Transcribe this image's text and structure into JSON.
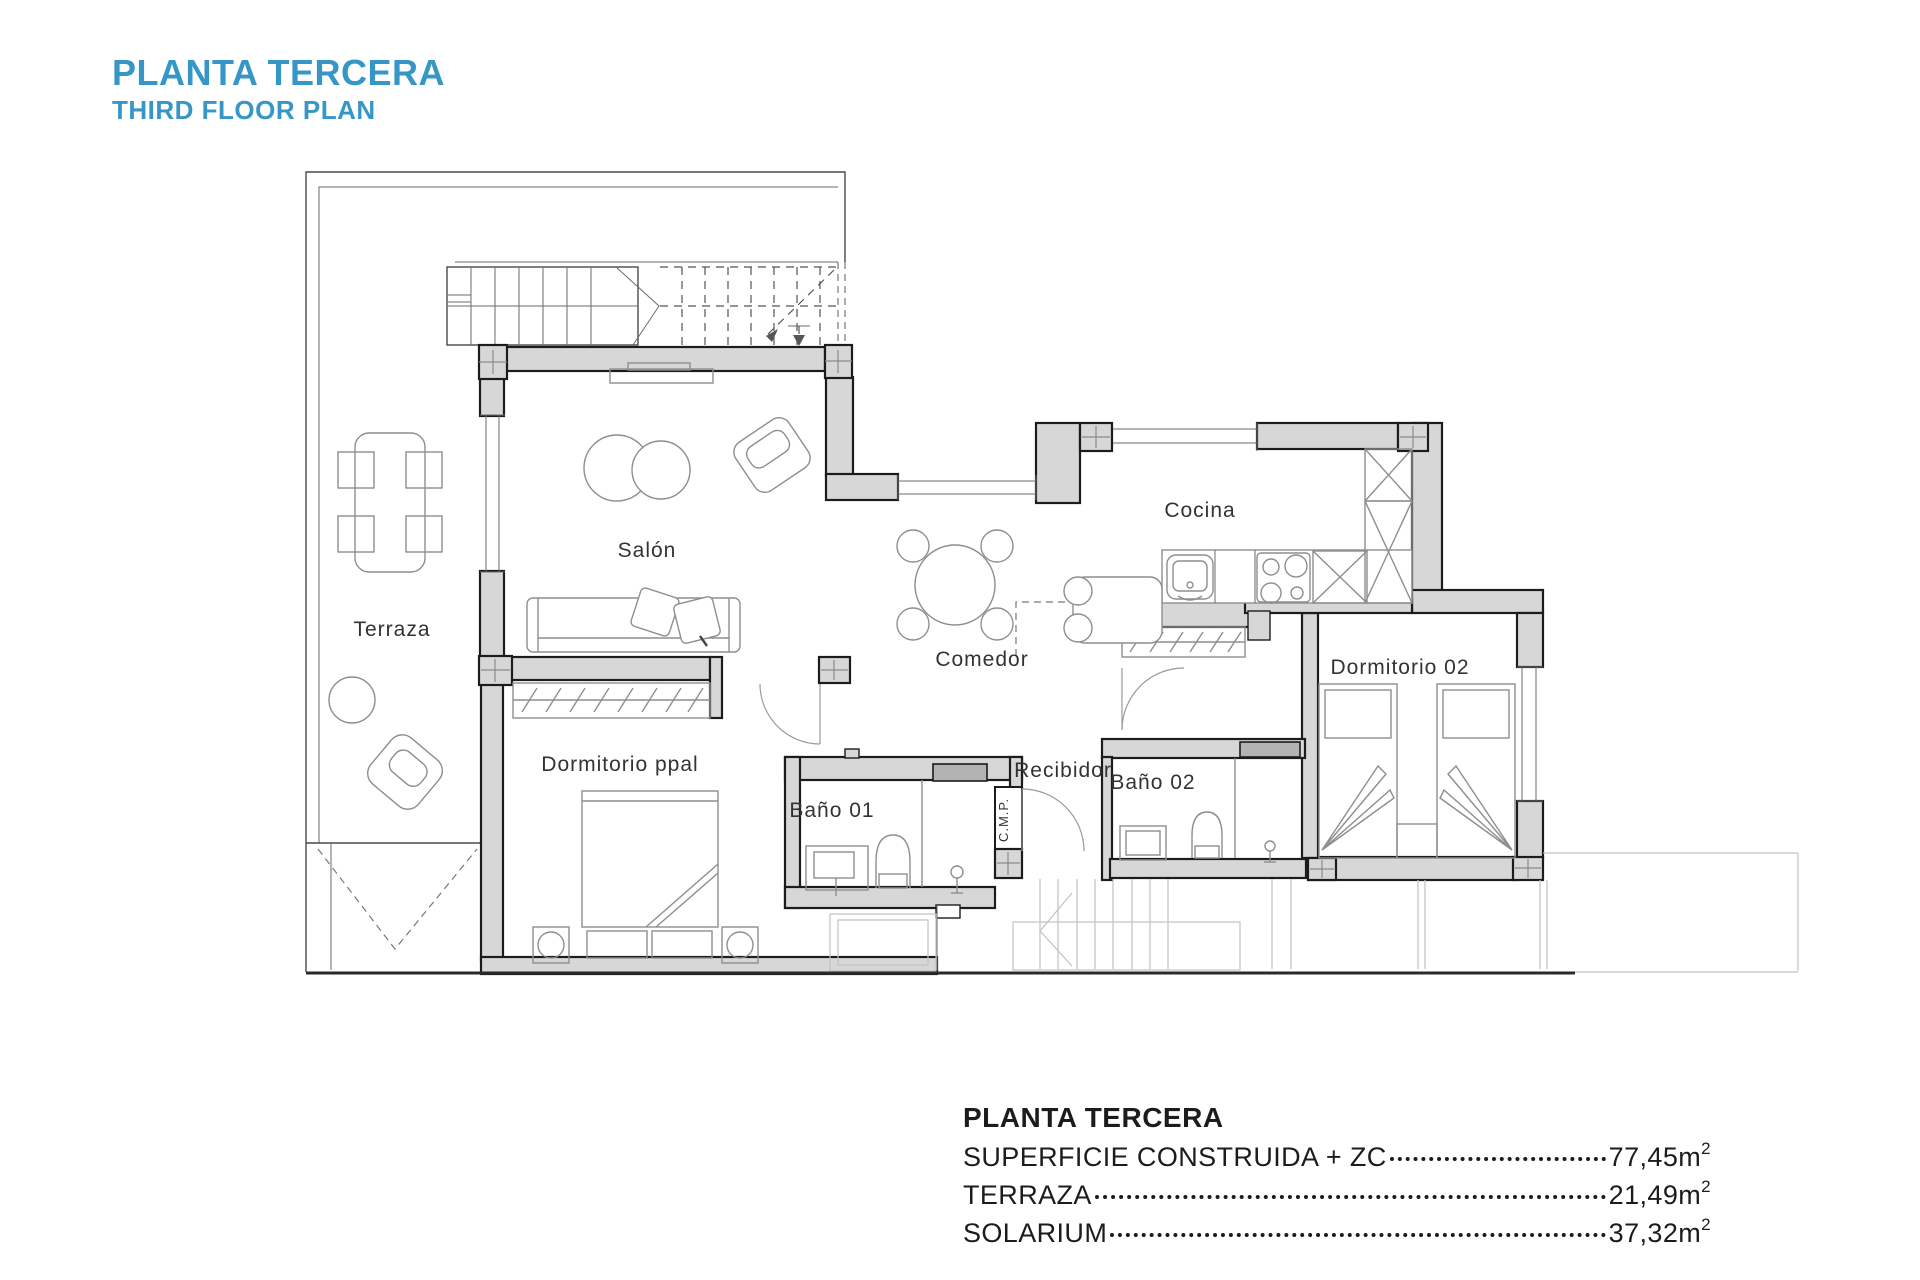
{
  "header": {
    "title": "PLANTA TERCERA",
    "subtitle": "THIRD FLOOR PLAN"
  },
  "rooms": {
    "terraza": "Terraza",
    "salon": "Salón",
    "comedor": "Comedor",
    "cocina": "Cocina",
    "dormitorio_ppal": "Dormitorio ppal",
    "bano_01": "Baño 01",
    "recibidor": "Recibidor",
    "bano_02": "Baño 02",
    "dormitorio_02": "Dormitorio 02",
    "cmp": "C.M.P."
  },
  "summary": {
    "title": "PLANTA TERCERA",
    "rows": [
      {
        "label": "SUPERFICIE CONSTRUIDA + ZC",
        "value": "77,45m",
        "sup": "2"
      },
      {
        "label": "TERRAZA",
        "value": "21,49m",
        "sup": "2"
      },
      {
        "label": "SOLARIUM",
        "value": "37,32m",
        "sup": "2"
      }
    ]
  },
  "colors": {
    "accent": "#3697c6",
    "wall_fill": "#d7d7d7",
    "line_dark": "#1c1c1c"
  }
}
